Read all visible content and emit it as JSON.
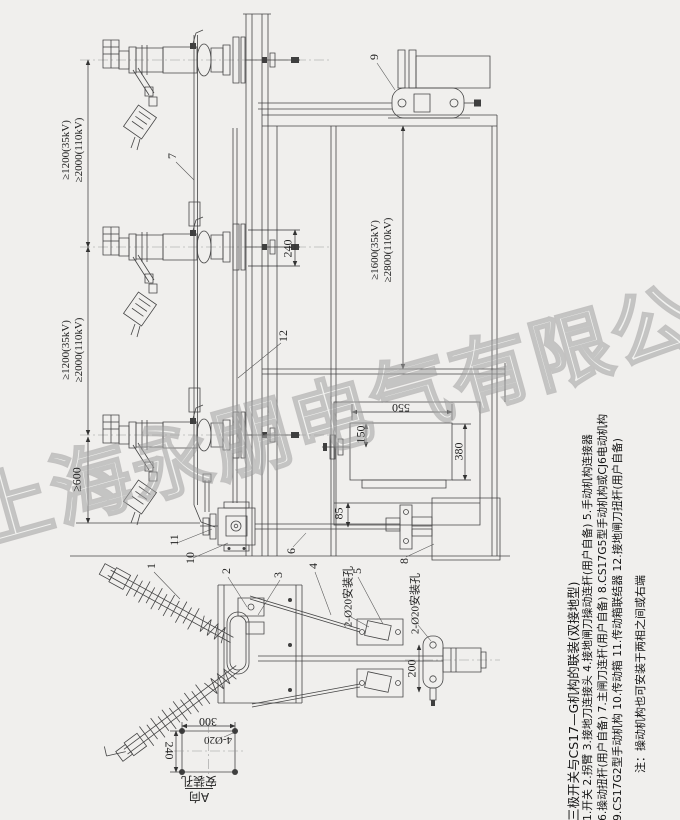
{
  "watermark": "上海永朋电气有限公司",
  "title_block": {
    "title": "三极开关与CS17—G机构的联装(双接地型)",
    "line1": "1.开关 2.拐臂 3.接地刀连接头 4.接地闸刀操动连杆(用户自备) 5.手动机构连接器",
    "line2": "6.操动扭杆(用户自备) 7.主闸刀连杆(用户自备) 8.CS17G5型手动机构或CJ6电动机构",
    "line3": "9.CS17G2型手动机构 10.传动箱 11.传动箱联结器 12.接地闸刀扭杆(用户自备)",
    "note": "注：操动机构也可安装于两相之间或右端"
  },
  "dimensions": {
    "phase_spacing_35kv": "≥1200(35kV)",
    "phase_spacing_110kv": "≥2000(110kV)",
    "height_35kv": "≥1600(35kV)",
    "height_110kv": "≥2800(110kV)",
    "end_clearance": "≥600",
    "pole_mount_spacing": "240",
    "mech_box_width": "550",
    "mech_shaft_offset": "150",
    "mech_box_height": "380",
    "rod_offset": "85",
    "mech_mount_height": "200",
    "mount_holes_note": "2-Ø20安装孔",
    "base_hole_width": "300",
    "base_hole_height": "240",
    "base_holes": "4-Ø20",
    "view_label": "A向",
    "view_sublabel": "安装孔"
  },
  "part_labels": [
    "1",
    "2",
    "3",
    "4",
    "5",
    "6",
    "7",
    "8",
    "9",
    "10",
    "11",
    "12"
  ]
}
